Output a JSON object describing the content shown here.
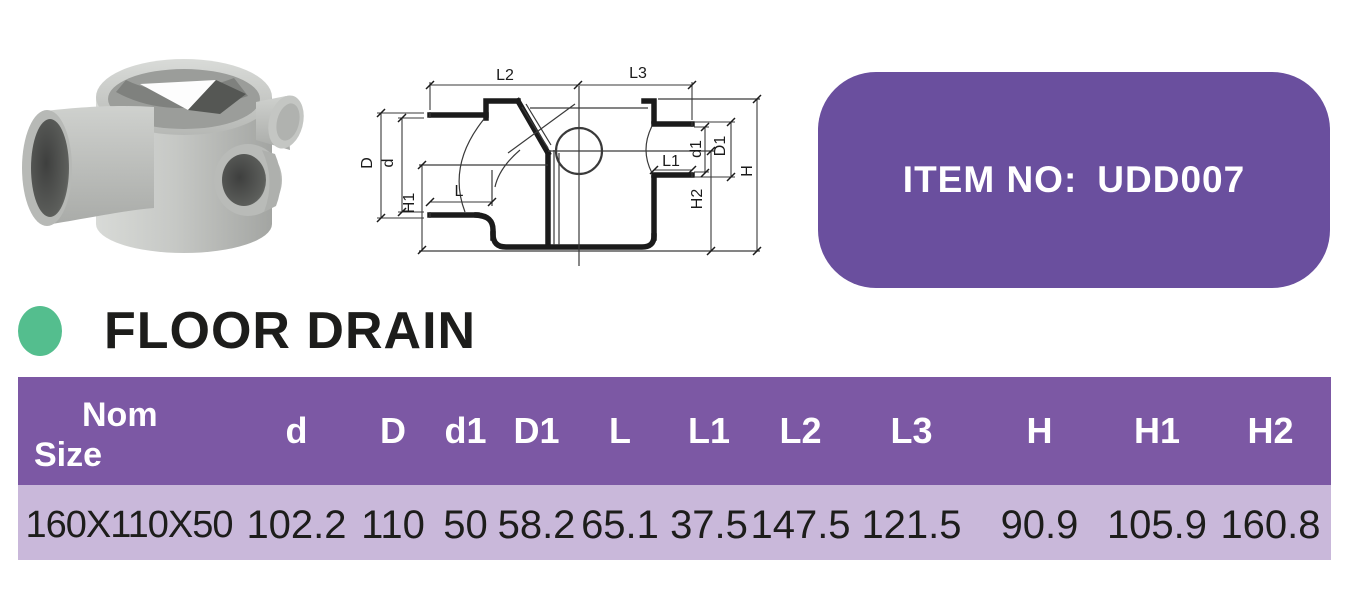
{
  "badge": {
    "label": "ITEM NO:",
    "value": "UDD007"
  },
  "section": {
    "title": "FLOOR DRAIN"
  },
  "drawing": {
    "labels": {
      "L2": "L2",
      "L3": "L3",
      "D": "D",
      "d": "d",
      "H1": "H1",
      "L": "L",
      "L1": "L1",
      "d1": "d1",
      "D1": "D1",
      "H2": "H2",
      "H": "H"
    }
  },
  "table": {
    "nom_header": {
      "line1": "Nom",
      "line2": "Size"
    },
    "headers": [
      "Nom Size",
      "d",
      "D",
      "d1",
      "D1",
      "L",
      "L1",
      "L2",
      "L3",
      "H",
      "H1",
      "H2"
    ],
    "rows": [
      [
        "160X110X50",
        "102.2",
        "110",
        "50",
        "58.2",
        "65.1",
        "37.5",
        "147.5",
        "121.5",
        "90.9",
        "105.9",
        "160.8"
      ]
    ]
  },
  "colors": {
    "badge-purple": "#6A4F9E",
    "header-purple": "#7C58A4",
    "row-lavender": "#C9B8DA",
    "dot-green": "#54BE8E",
    "ink": "#1D1D1B",
    "drawing-ink": "#1B1B1B"
  }
}
